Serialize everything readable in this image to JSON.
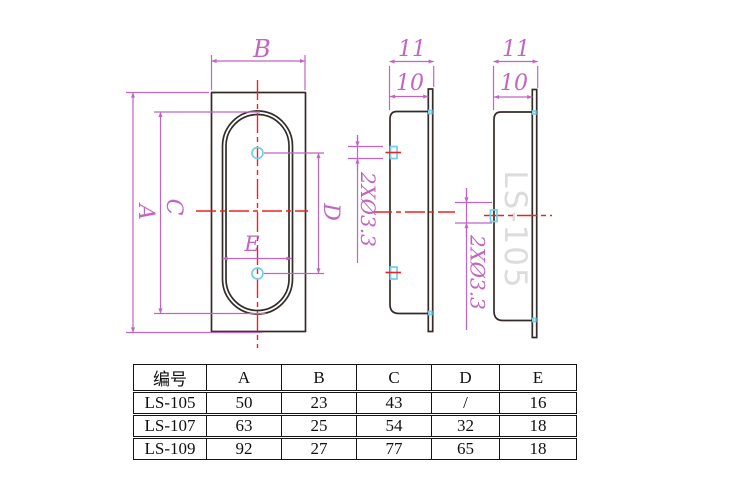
{
  "drawing": {
    "front": {
      "dim_a": "A",
      "dim_b": "B",
      "dim_c": "C",
      "dim_d": "D",
      "dim_e": "E"
    },
    "mid": {
      "d11": "11",
      "d10": "10",
      "note": "2XØ3.3"
    },
    "right": {
      "d11": "11",
      "d10": "10",
      "note": "2XØ3.3",
      "watermark": "LS-105"
    },
    "colors": {
      "dimension": "#c165c3",
      "centerline": "#ee2222",
      "hole_marker": "#72cfe6",
      "outline": "#332c28",
      "watermark": "#dcdcdc"
    }
  },
  "spec_table": {
    "headers": [
      "编号",
      "A",
      "B",
      "C",
      "D",
      "E"
    ],
    "rows": [
      [
        "LS-105",
        "50",
        "23",
        "43",
        "/",
        "16"
      ],
      [
        "LS-107",
        "63",
        "25",
        "54",
        "32",
        "18"
      ],
      [
        "LS-109",
        "92",
        "27",
        "77",
        "65",
        "18"
      ]
    ]
  }
}
